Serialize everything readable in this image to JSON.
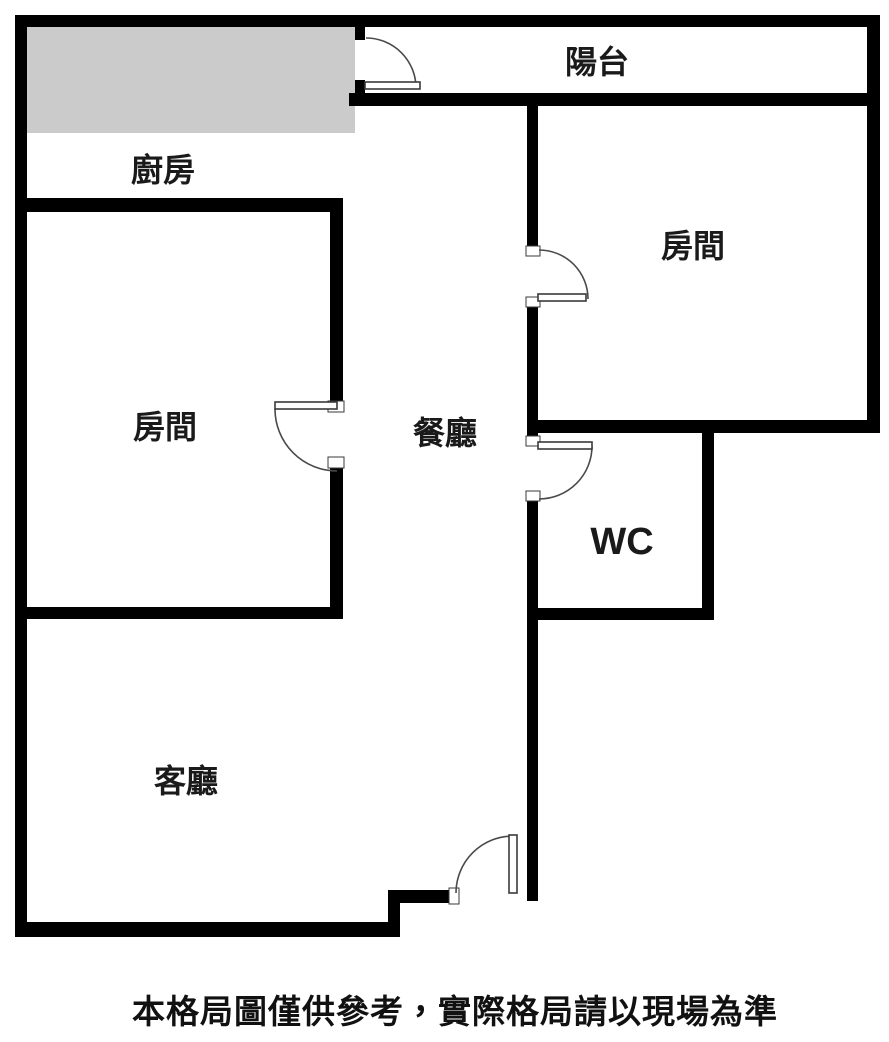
{
  "floor_plan": {
    "labels": {
      "balcony": "陽台",
      "kitchen": "廚房",
      "bedroom_right": "房間",
      "bedroom_left": "房間",
      "dining": "餐廳",
      "wc": "WC",
      "living": "客廳"
    },
    "disclaimer": "本格局圖僅供參考，實際格局請以現場為準",
    "colors": {
      "wall": "#000000",
      "counter": "#cbcbcb",
      "background": "#ffffff"
    }
  }
}
